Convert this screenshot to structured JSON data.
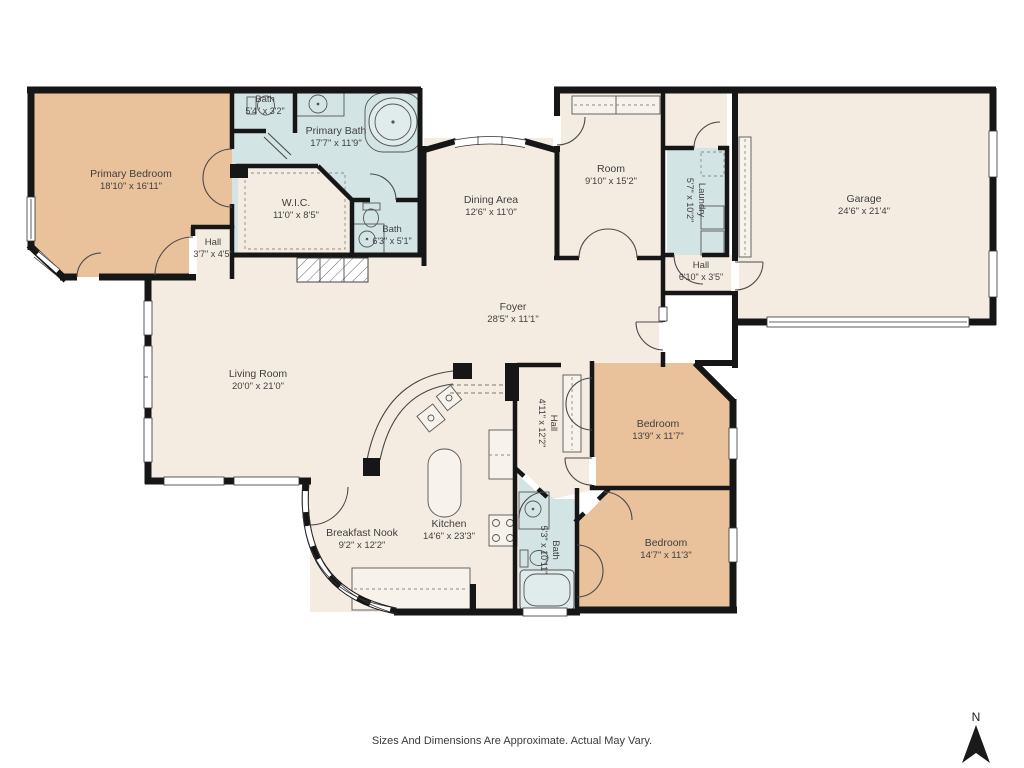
{
  "colors": {
    "bedroom_fill": "#e9c19b",
    "bath_fill": "#d3e4e5",
    "room_fill": "#f4ece1",
    "wall_color": "#161616",
    "label_color": "#3f3f3f"
  },
  "rooms": [
    {
      "name": "Primary Bedroom",
      "dims": "18'10\" x 16'11\""
    },
    {
      "name": "Bath",
      "dims": "5'4\" x 3'2\""
    },
    {
      "name": "Primary Bath",
      "dims": "17'7\" x 11'9\""
    },
    {
      "name": "W.I.C.",
      "dims": "11'0\" x 8'5\""
    },
    {
      "name": "Hall",
      "dims": "3'7\" x 4'5\""
    },
    {
      "name": "Bath",
      "dims": "6'3\" x 5'1\""
    },
    {
      "name": "Dining Area",
      "dims": "12'6\" x 11'0\""
    },
    {
      "name": "Room",
      "dims": "9'10\" x 15'2\""
    },
    {
      "name": "Laundry",
      "dims": "5'7\" x 10'2\""
    },
    {
      "name": "Garage",
      "dims": "24'6\" x 21'4\""
    },
    {
      "name": "Hall",
      "dims": "6'10\" x 3'5\""
    },
    {
      "name": "Foyer",
      "dims": "28'5\" x 11'1\""
    },
    {
      "name": "Living Room",
      "dims": "20'0\" x 21'0\""
    },
    {
      "name": "Hall",
      "dims": "4'11\" x 12'2\""
    },
    {
      "name": "Bedroom",
      "dims": "13'9\" x 11'7\""
    },
    {
      "name": "Bedroom",
      "dims": "14'7\" x 11'3\""
    },
    {
      "name": "Kitchen",
      "dims": "14'6\" x 23'3\""
    },
    {
      "name": "Breakfast Nook",
      "dims": "9'2\" x 12'2\""
    },
    {
      "name": "Bath",
      "dims": "5'3\" x 10'11\""
    }
  ],
  "footer": {
    "disclaimer": "Sizes And Dimensions Are Approximate. Actual May Vary."
  },
  "compass": {
    "label": "N"
  }
}
